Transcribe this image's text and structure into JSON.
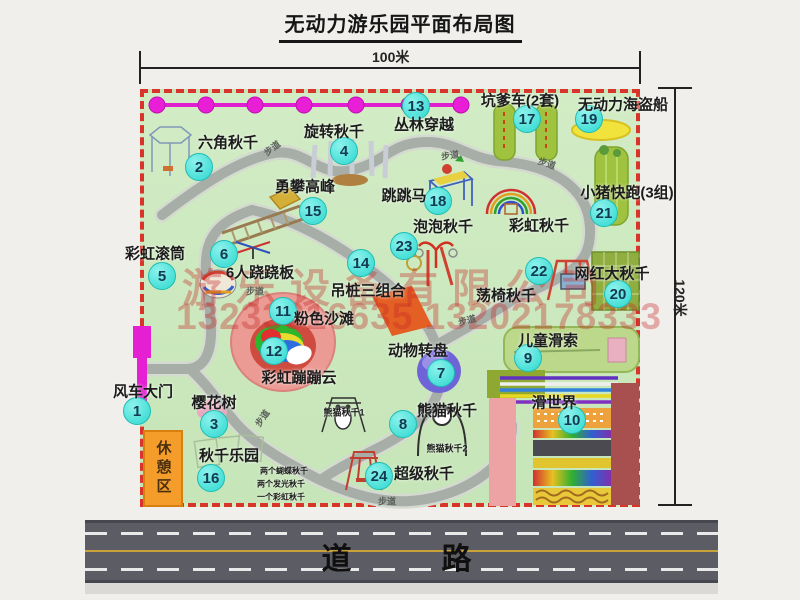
{
  "title": "无动力游乐园平面布局图",
  "dim_width": "100米",
  "dim_height": "120米",
  "road_label": "道　　路",
  "watermark_line1": "游乐设备有限公司",
  "watermark_line2": "13233816635 13202178333",
  "rest_area_label": "休憩区",
  "walkway_label": "步道",
  "walkway_positions": [
    {
      "x": 272,
      "y": 148,
      "rot": -38
    },
    {
      "x": 450,
      "y": 155,
      "rot": -8
    },
    {
      "x": 547,
      "y": 163,
      "rot": 18
    },
    {
      "x": 255,
      "y": 291,
      "rot": 0
    },
    {
      "x": 262,
      "y": 418,
      "rot": -55
    },
    {
      "x": 467,
      "y": 320,
      "rot": -15
    },
    {
      "x": 387,
      "y": 501,
      "rot": 0
    }
  ],
  "attractions": [
    {
      "num": "1",
      "name": "风车大门",
      "badge": [
        136,
        410
      ],
      "label": [
        143,
        391
      ]
    },
    {
      "num": "2",
      "name": "六角秋千",
      "badge": [
        198,
        166
      ],
      "label": [
        228,
        142
      ]
    },
    {
      "num": "3",
      "name": "樱花树",
      "badge": [
        213,
        423
      ],
      "label": [
        214,
        402
      ]
    },
    {
      "num": "4",
      "name": "旋转秋千",
      "badge": [
        343,
        150
      ],
      "label": [
        334,
        131
      ]
    },
    {
      "num": "5",
      "name": "彩虹滚筒",
      "badge": [
        161,
        275
      ],
      "label": [
        155,
        253
      ]
    },
    {
      "num": "6",
      "name": "6人跷跷板",
      "badge": [
        223,
        253
      ],
      "label": [
        260,
        272
      ]
    },
    {
      "num": "7",
      "name": "动物转盘",
      "badge": [
        440,
        372
      ],
      "label": [
        418,
        350
      ]
    },
    {
      "num": "8",
      "name": "熊猫秋千",
      "badge": [
        402,
        423
      ],
      "label": [
        447,
        410
      ]
    },
    {
      "num": "9",
      "name": "儿童滑索",
      "badge": [
        527,
        357
      ],
      "label": [
        548,
        340
      ]
    },
    {
      "num": "10",
      "name": "滑世界",
      "badge": [
        571,
        419
      ],
      "label": [
        554,
        402
      ]
    },
    {
      "num": "11",
      "name": "粉色沙滩",
      "badge": [
        282,
        310
      ],
      "label": [
        324,
        318
      ]
    },
    {
      "num": "12",
      "name": "彩虹蹦蹦云",
      "badge": [
        273,
        350
      ],
      "label": [
        299,
        377
      ]
    },
    {
      "num": "13",
      "name": "丛林穿越",
      "badge": [
        415,
        105
      ],
      "label": [
        424,
        124
      ]
    },
    {
      "num": "14",
      "name": "吊桩三组合",
      "badge": [
        360,
        262
      ],
      "label": [
        368,
        290
      ]
    },
    {
      "num": "15",
      "name": "勇攀高峰",
      "badge": [
        312,
        210
      ],
      "label": [
        305,
        186
      ]
    },
    {
      "num": "16",
      "name": "秋千乐园",
      "badge": [
        210,
        477
      ],
      "label": [
        229,
        455
      ]
    },
    {
      "num": "17",
      "name": "坑爹车(2套)",
      "badge": [
        526,
        118
      ],
      "label": [
        520,
        100
      ]
    },
    {
      "num": "18",
      "name": "跳跳马",
      "badge": [
        437,
        200
      ],
      "label": [
        404,
        195
      ]
    },
    {
      "num": "19",
      "name": "无动力海盗船",
      "badge": [
        588,
        118
      ],
      "label": [
        623,
        104
      ]
    },
    {
      "num": "20",
      "name": "网红大秋千",
      "badge": [
        617,
        293
      ],
      "label": [
        612,
        273
      ]
    },
    {
      "num": "21",
      "name": "小猪快跑(3组)",
      "badge": [
        603,
        212
      ],
      "label": [
        627,
        192
      ]
    },
    {
      "num": "22",
      "name": "荡椅秋千",
      "badge": [
        538,
        270
      ],
      "label": [
        506,
        295
      ]
    },
    {
      "num": "23",
      "name": "泡泡秋千",
      "badge": [
        403,
        245
      ],
      "label": [
        443,
        226
      ]
    },
    {
      "num": "24",
      "name": "超级秋千",
      "badge": [
        378,
        475
      ],
      "label": [
        424,
        473
      ]
    }
  ],
  "extra_labels": [
    {
      "text": "彩虹秋千",
      "x": 539,
      "y": 225,
      "size": 15
    },
    {
      "text": "熊猫秋千1",
      "x": 344,
      "y": 412,
      "size": 9
    },
    {
      "text": "熊猫秋千2",
      "x": 447,
      "y": 448,
      "size": 9
    },
    {
      "text": "两个蝴蝶秋千",
      "x": 284,
      "y": 471,
      "size": 8
    },
    {
      "text": "两个发光秋千",
      "x": 281,
      "y": 484,
      "size": 8
    },
    {
      "text": "一个彩虹秋千",
      "x": 281,
      "y": 497,
      "size": 8
    }
  ]
}
